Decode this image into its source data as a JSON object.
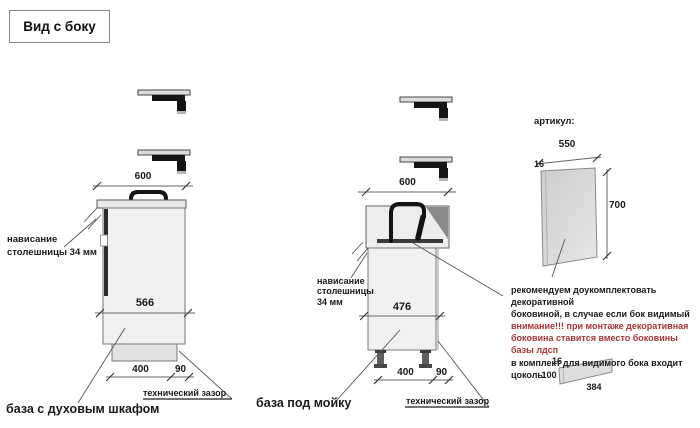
{
  "title": "Вид с боку",
  "left_unit": {
    "caption": "база с духовым шкафом",
    "top_width": "600",
    "overhang_line1": "нависание",
    "overhang_line2": "столешницы 34 мм",
    "depth": "566",
    "plinth_depth": "400",
    "gap": "90",
    "gap_label": "технический зазор"
  },
  "sink_unit": {
    "caption": "база под мойку",
    "top_width": "600",
    "overhang_line1": "нависание",
    "overhang_line2": "столешницы",
    "overhang_line3": "34 мм",
    "depth": "476",
    "plinth_depth": "400",
    "gap": "90",
    "gap_label": "технический зазор"
  },
  "side_panel": {
    "label": "артикул:",
    "width": "550",
    "thickness": "16",
    "height": "700"
  },
  "note": {
    "line1": "рекомендуем доукомплектовать декоративной",
    "line2": "боковиной, в случае если бок видимый",
    "line3": "внимание!!! при монтаже декоративная",
    "line4": "боковина ставится вместо боковины базы лдсп",
    "line5": "в комплект для видимого бока входит цоколь:",
    "warning_color": "#a83535"
  },
  "plinth_strip": {
    "thickness": "16",
    "height": "100",
    "length": "384"
  }
}
